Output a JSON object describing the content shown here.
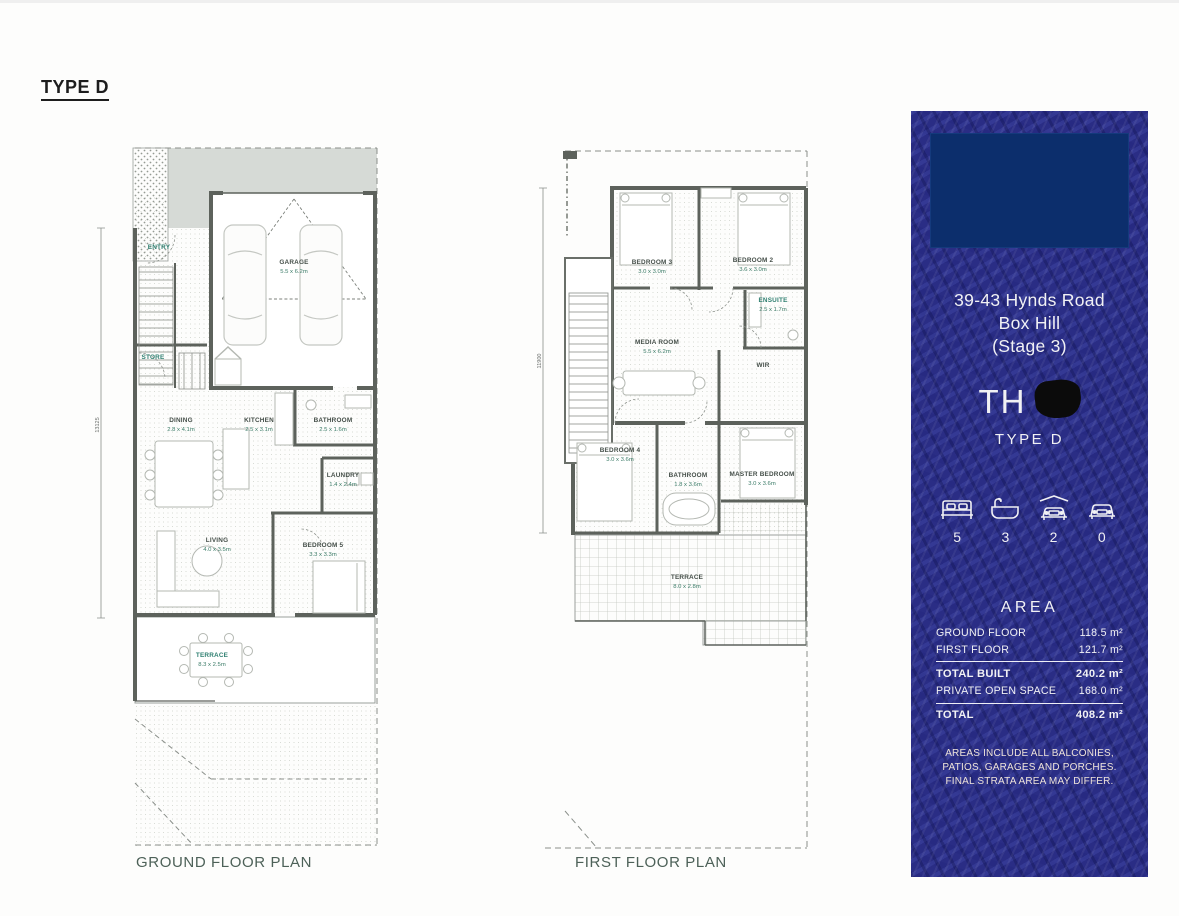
{
  "page": {
    "title": "TYPE D"
  },
  "ground_plan": {
    "caption": "GROUND FLOOR PLAN",
    "side_dimension": "13125",
    "rooms": {
      "entry": {
        "name": "ENTRY"
      },
      "store": {
        "name": "STORE"
      },
      "garage": {
        "name": "GARAGE",
        "dims": "5.5 x 6.2m"
      },
      "dining": {
        "name": "DINING",
        "dims": "2.8 x 4.1m"
      },
      "kitchen": {
        "name": "KITCHEN",
        "dims": "2.5 x 3.1m"
      },
      "bathroom": {
        "name": "BATHROOM",
        "dims": "2.5 x 1.6m"
      },
      "laundry": {
        "name": "LAUNDRY",
        "dims": "1.4 x 2.4m"
      },
      "living": {
        "name": "LIVING",
        "dims": "4.0 x 3.5m"
      },
      "bedroom5": {
        "name": "BEDROOM 5",
        "dims": "3.3 x 3.3m"
      },
      "terrace": {
        "name": "TERRACE",
        "dims": "8.3 x 2.5m"
      }
    }
  },
  "first_plan": {
    "caption": "FIRST FLOOR PLAN",
    "side_dimension": "11900",
    "rooms": {
      "bedroom3": {
        "name": "BEDROOM 3",
        "dims": "3.0 x 3.0m"
      },
      "bedroom2": {
        "name": "BEDROOM 2",
        "dims": "3.6 x 3.0m"
      },
      "ensuite": {
        "name": "ENSUITE",
        "dims": "2.5 x 1.7m"
      },
      "media": {
        "name": "MEDIA ROOM",
        "dims": "5.5 x 6.2m"
      },
      "wir": {
        "name": "WIR"
      },
      "bedroom4": {
        "name": "BEDROOM 4",
        "dims": "3.0 x 3.6m"
      },
      "bathroom": {
        "name": "BATHROOM",
        "dims": "1.8 x 3.6m"
      },
      "master": {
        "name": "MASTER BEDROOM",
        "dims": "3.0 x 3.6m"
      },
      "terrace": {
        "name": "TERRACE",
        "dims": "8.0 x 2.8m"
      }
    }
  },
  "info_panel": {
    "address_line1": "39-43 Hynds Road",
    "address_line2": "Box Hill",
    "address_line3": "(Stage 3)",
    "unit_prefix": "TH",
    "type_label": "TYPE D",
    "features": [
      {
        "icon": "bed-icon",
        "count": "5"
      },
      {
        "icon": "bath-icon",
        "count": "3"
      },
      {
        "icon": "garage-icon",
        "count": "2"
      },
      {
        "icon": "car-icon",
        "count": "0"
      }
    ],
    "area": {
      "title": "AREA",
      "rows": [
        {
          "label": "GROUND FLOOR",
          "value": "118.5 m²"
        },
        {
          "label": "FIRST FLOOR",
          "value": "121.7 m²"
        },
        {
          "label": "TOTAL BUILT",
          "value": "240.2 m²"
        },
        {
          "label": "PRIVATE OPEN SPACE",
          "value": "168.0 m²"
        },
        {
          "label": "TOTAL",
          "value": "408.2 m²"
        }
      ]
    },
    "disclaimer_line1": "AREAS INCLUDE ALL BALCONIES,",
    "disclaimer_line2": "PATIOS, GARAGES AND PORCHES.",
    "disclaimer_line3": "FINAL STRATA AREA MAY DIFFER."
  },
  "colors": {
    "panel_blue": "#2a2d85",
    "logo_navy": "#0c2e6c",
    "dimension_green": "#3c7c68",
    "caption_green": "#4d6158"
  }
}
